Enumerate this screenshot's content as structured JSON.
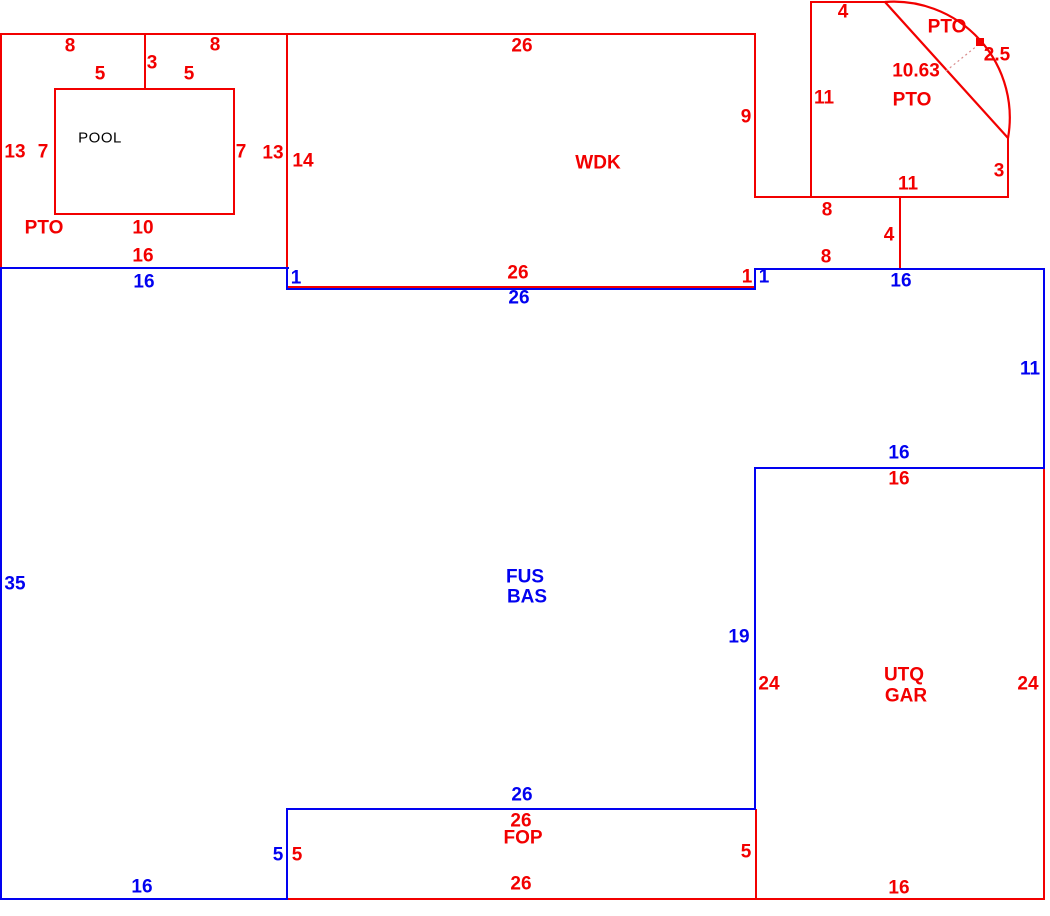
{
  "title": "Appraisal floor plan sketch",
  "colors": {
    "red": "#f20000",
    "blue": "#0202f0",
    "black": "#000000"
  },
  "areas": [
    "POOL",
    "PTO",
    "WDK",
    "PTO (arc)",
    "FUS/BAS",
    "UTQ/GAR",
    "FOP"
  ],
  "labels": [
    {
      "t": "8",
      "x": 70,
      "y": 46,
      "c": "r"
    },
    {
      "t": "3",
      "x": 152,
      "y": 63,
      "c": "r"
    },
    {
      "t": "8",
      "x": 215,
      "y": 45,
      "c": "r"
    },
    {
      "t": "5",
      "x": 100,
      "y": 74,
      "c": "r"
    },
    {
      "t": "5",
      "x": 189,
      "y": 74,
      "c": "r"
    },
    {
      "t": "13",
      "x": 15,
      "y": 152,
      "c": "r"
    },
    {
      "t": "7",
      "x": 43,
      "y": 152,
      "c": "r"
    },
    {
      "t": "POOL",
      "x": 100,
      "y": 138,
      "c": "k",
      "a": "pool"
    },
    {
      "t": "7",
      "x": 241,
      "y": 152,
      "c": "r"
    },
    {
      "t": "13",
      "x": 273,
      "y": 153,
      "c": "r"
    },
    {
      "t": "14",
      "x": 303,
      "y": 161,
      "c": "r"
    },
    {
      "t": "PTO",
      "x": 44,
      "y": 228,
      "c": "r",
      "a": "pto"
    },
    {
      "t": "10",
      "x": 143,
      "y": 228,
      "c": "r"
    },
    {
      "t": "16",
      "x": 143,
      "y": 256,
      "c": "r"
    },
    {
      "t": "16",
      "x": 144,
      "y": 282,
      "c": "b"
    },
    {
      "t": "26",
      "x": 522,
      "y": 46,
      "c": "r"
    },
    {
      "t": "WDK",
      "x": 598,
      "y": 163,
      "c": "r",
      "a": "wdk"
    },
    {
      "t": "9",
      "x": 746,
      "y": 117,
      "c": "r"
    },
    {
      "t": "1",
      "x": 296,
      "y": 278,
      "c": "b"
    },
    {
      "t": "26",
      "x": 518,
      "y": 273,
      "c": "r"
    },
    {
      "t": "26",
      "x": 519,
      "y": 298,
      "c": "b"
    },
    {
      "t": "1",
      "x": 747,
      "y": 277,
      "c": "r"
    },
    {
      "t": "1",
      "x": 764,
      "y": 277,
      "c": "b"
    },
    {
      "t": "4",
      "x": 843,
      "y": 12,
      "c": "r"
    },
    {
      "t": "PTO",
      "x": 947,
      "y": 27,
      "c": "r",
      "a": "pto-arc"
    },
    {
      "t": "2.5",
      "x": 997,
      "y": 55,
      "c": "r"
    },
    {
      "t": "10.63",
      "x": 916,
      "y": 71,
      "c": "r"
    },
    {
      "t": "PTO",
      "x": 912,
      "y": 100,
      "c": "r",
      "a": "pto-arc"
    },
    {
      "t": "11",
      "x": 824,
      "y": 98,
      "c": "r"
    },
    {
      "t": "3",
      "x": 999,
      "y": 171,
      "c": "r"
    },
    {
      "t": "11",
      "x": 908,
      "y": 184,
      "c": "r"
    },
    {
      "t": "8",
      "x": 827,
      "y": 210,
      "c": "r"
    },
    {
      "t": "4",
      "x": 889,
      "y": 235,
      "c": "r"
    },
    {
      "t": "8",
      "x": 826,
      "y": 257,
      "c": "r"
    },
    {
      "t": "16",
      "x": 901,
      "y": 281,
      "c": "b"
    },
    {
      "t": "11",
      "x": 1030,
      "y": 369,
      "c": "b"
    },
    {
      "t": "16",
      "x": 899,
      "y": 453,
      "c": "b"
    },
    {
      "t": "16",
      "x": 899,
      "y": 479,
      "c": "r"
    },
    {
      "t": "FUS",
      "x": 525,
      "y": 577,
      "c": "b",
      "a": "fus"
    },
    {
      "t": "BAS",
      "x": 527,
      "y": 597,
      "c": "b",
      "a": "bas"
    },
    {
      "t": "35",
      "x": 15,
      "y": 584,
      "c": "b"
    },
    {
      "t": "19",
      "x": 739,
      "y": 637,
      "c": "b"
    },
    {
      "t": "24",
      "x": 769,
      "y": 684,
      "c": "r"
    },
    {
      "t": "UTQ",
      "x": 904,
      "y": 675,
      "c": "r",
      "a": "utq"
    },
    {
      "t": "GAR",
      "x": 906,
      "y": 696,
      "c": "r",
      "a": "gar"
    },
    {
      "t": "24",
      "x": 1028,
      "y": 684,
      "c": "r"
    },
    {
      "t": "26",
      "x": 522,
      "y": 795,
      "c": "b"
    },
    {
      "t": "26",
      "x": 521,
      "y": 821,
      "c": "r"
    },
    {
      "t": "FOP",
      "x": 523,
      "y": 838,
      "c": "r",
      "a": "fop"
    },
    {
      "t": "5",
      "x": 278,
      "y": 855,
      "c": "b"
    },
    {
      "t": "5",
      "x": 297,
      "y": 855,
      "c": "r"
    },
    {
      "t": "5",
      "x": 746,
      "y": 852,
      "c": "r"
    },
    {
      "t": "16",
      "x": 142,
      "y": 887,
      "c": "b"
    },
    {
      "t": "26",
      "x": 521,
      "y": 884,
      "c": "r"
    },
    {
      "t": "16",
      "x": 899,
      "y": 888,
      "c": "r"
    }
  ]
}
